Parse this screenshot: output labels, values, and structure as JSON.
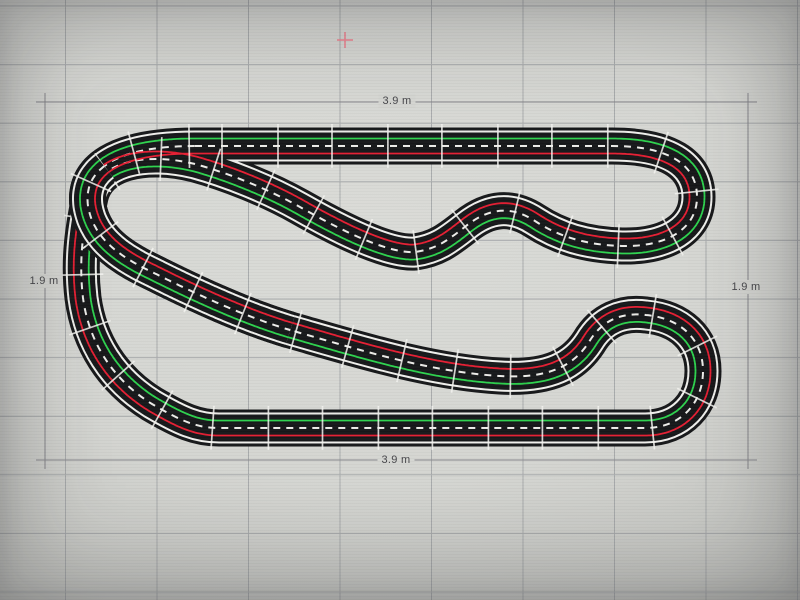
{
  "scene": {
    "width": 800,
    "height": 600,
    "background_center": "#dadbd7",
    "background_edge": "#a2a3a0"
  },
  "grid": {
    "color": "#9a9da0",
    "opacity": 0.75,
    "stroke_width": 1,
    "vertical": {
      "start": 65.5,
      "step": 91.5,
      "count": 9
    },
    "horizontal": {
      "start": 6,
      "step": 58.6,
      "count": 11
    }
  },
  "dimension_box": {
    "x1": 45,
    "y1": 102,
    "x2": 748,
    "y2": 460,
    "line_color": "#85858a",
    "overshoot": 9,
    "label_color": "#46464a",
    "label_bg": "#d4d5d1",
    "labels": {
      "top": {
        "text": "3.9 m",
        "x": 397,
        "y": 101
      },
      "bottom": {
        "text": "3.9 m",
        "x": 396,
        "y": 460
      },
      "left": {
        "text": "1.9 m",
        "x": 44,
        "y": 281
      },
      "right": {
        "text": "1.9 m",
        "x": 746,
        "y": 287
      }
    }
  },
  "marker": {
    "x": 345,
    "y": 40,
    "arm": 8,
    "color": "#ee7d8b"
  },
  "track": {
    "path": "M195,146 L612,146 C668,146 697,164 697,197 C697,228 668,247 622,246 C585,245 558,236 535,221 C512,206 490,207 466,226 C447,241 436,249 415,252 C385,254 330,224 300,207 C268,189 228,173 195,164 C146,152 98,161 90,197 C82,234 79,264 83,298 C89,342 112,379 152,404 C181,421 197,428 219,428 L645,428 C681,428 703,403 703,371 C703,338 679,318 646,315 C622,312 602,320 589,342 C574,365 550,379 500,376 C430,372 360,350 290,330 C240,315 190,291 152,272 C116,255 93,236 88,206 C83,170 115,146 195,146 Z",
    "body_width": 37,
    "edge_width": 31,
    "inner_width": 27,
    "body_color": "#17181a",
    "edge_color": "#efefec",
    "center_dash": {
      "color": "#ededea",
      "width": 2,
      "pattern": "7 6"
    },
    "lane_offset": 7.5,
    "lane_width": 1.8,
    "red_lane_color": "#e51f33",
    "green_lane_color": "#2ed24e",
    "joints": {
      "step": 55,
      "length": 44,
      "width": 1.7,
      "color": "rgba(243,243,240,0.85)"
    },
    "overlay": {
      "from": [
        290,
        330
      ],
      "to": [
        105,
        168
      ]
    }
  }
}
